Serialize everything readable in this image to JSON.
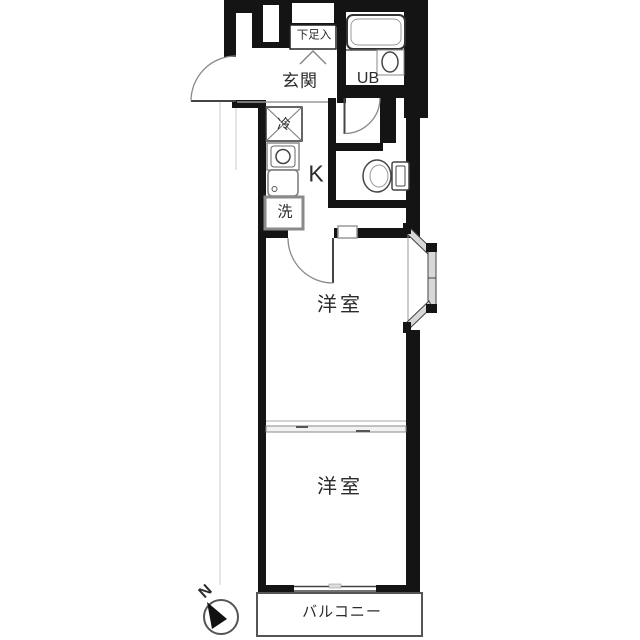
{
  "floorplan": {
    "type": "apartment-floor-plan",
    "rooms": {
      "entrance": "玄関",
      "shoe_storage": "下足入",
      "unit_bath": "UB",
      "kitchen": "K",
      "western_room_1": "洋室",
      "western_room_2": "洋室",
      "balcony": "バルコニー"
    },
    "fixtures": {
      "refrigerator": "冷",
      "washing_machine": "洗"
    },
    "compass": {
      "north_label": "N",
      "needle_direction": "upper-left"
    },
    "icons": [
      "bathtub-icon",
      "washbasin-icon",
      "toilet-icon",
      "stove-icon",
      "sink-icon",
      "door-swing-arc",
      "folding-door-symbol",
      "bay-window",
      "sliding-partition",
      "compass-icon"
    ],
    "colors": {
      "wall": "#141414",
      "thin_line": "#555555",
      "light_line": "#999999",
      "window_fill": "#d8d8d8",
      "text": "#2b2b2b",
      "background": "#ffffff"
    }
  }
}
